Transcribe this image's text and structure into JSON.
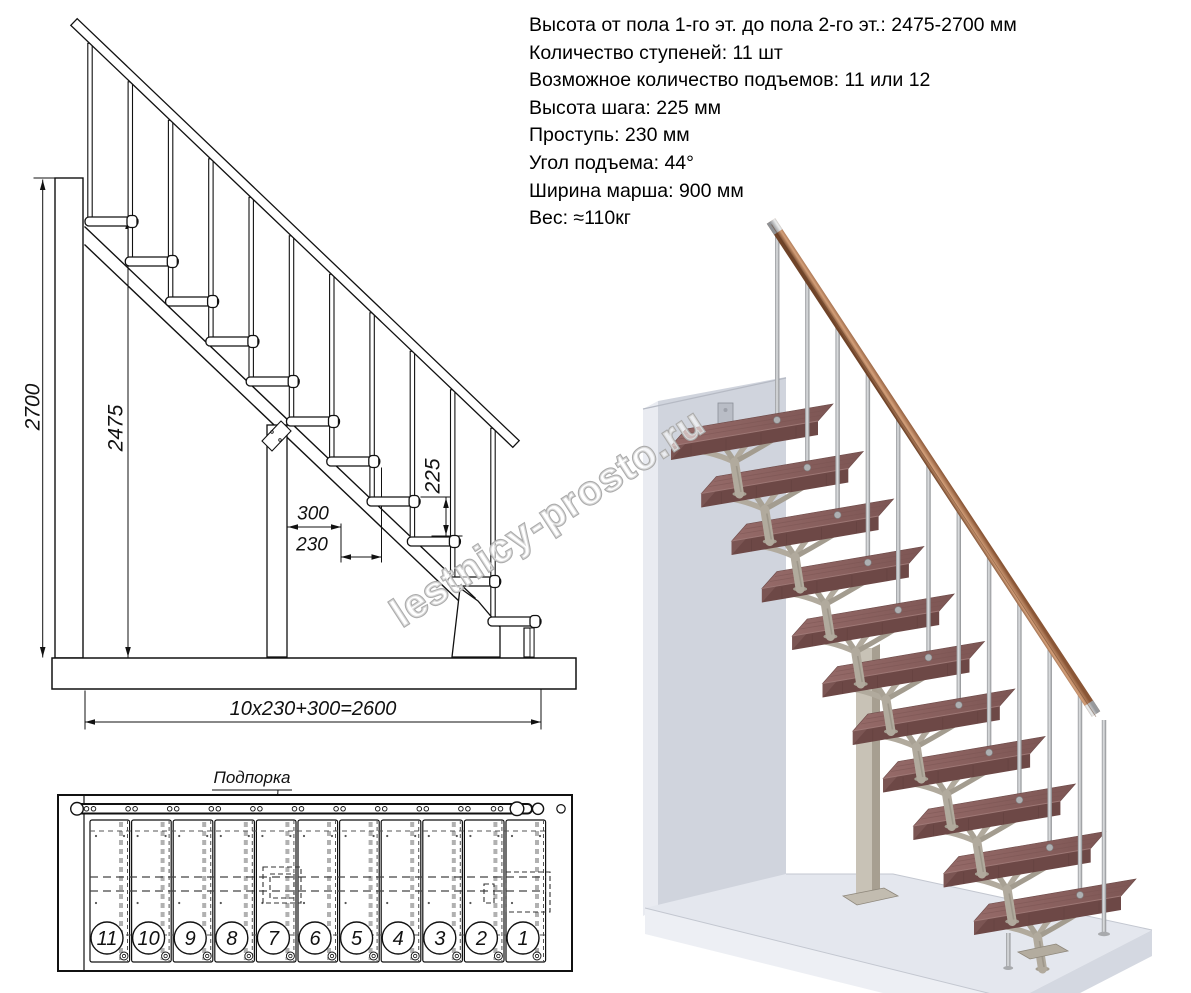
{
  "specs": {
    "lines": [
      "Высота от пола 1-го эт. до пола 2-го эт.: 2475-2700 мм",
      "Количество ступеней: 11 шт",
      "Возможное количество подъемов: 11 или 12",
      "Высота шага: 225 мм",
      "Проступь: 230 мм",
      "Угол подъема: 44°",
      "Ширина марша: 900 мм",
      "Вес: ≈110кг"
    ]
  },
  "side_view": {
    "dims": {
      "total_height": "2700",
      "clear_height": "2475",
      "rise": "225",
      "top_run": "300",
      "tread_run": "230",
      "total_run": "10x230+300=2600"
    }
  },
  "plan_view": {
    "support_label": "Подпорка",
    "steps": [
      "11",
      "10",
      "9",
      "8",
      "7",
      "6",
      "5",
      "4",
      "3",
      "2",
      "1"
    ]
  },
  "watermark": {
    "text": "lestnicy-prosto.ru"
  },
  "colors": {
    "line": "#111111",
    "tread_top": "#8d6361",
    "tread_front": "#6d4846",
    "support": "#b1aa9d",
    "rail_copper": "#b97f55",
    "metal": "#c9cbcd",
    "wall": "#d0d4dd",
    "floor": "#e4e7ee",
    "watermark_outline": "#ababab"
  }
}
